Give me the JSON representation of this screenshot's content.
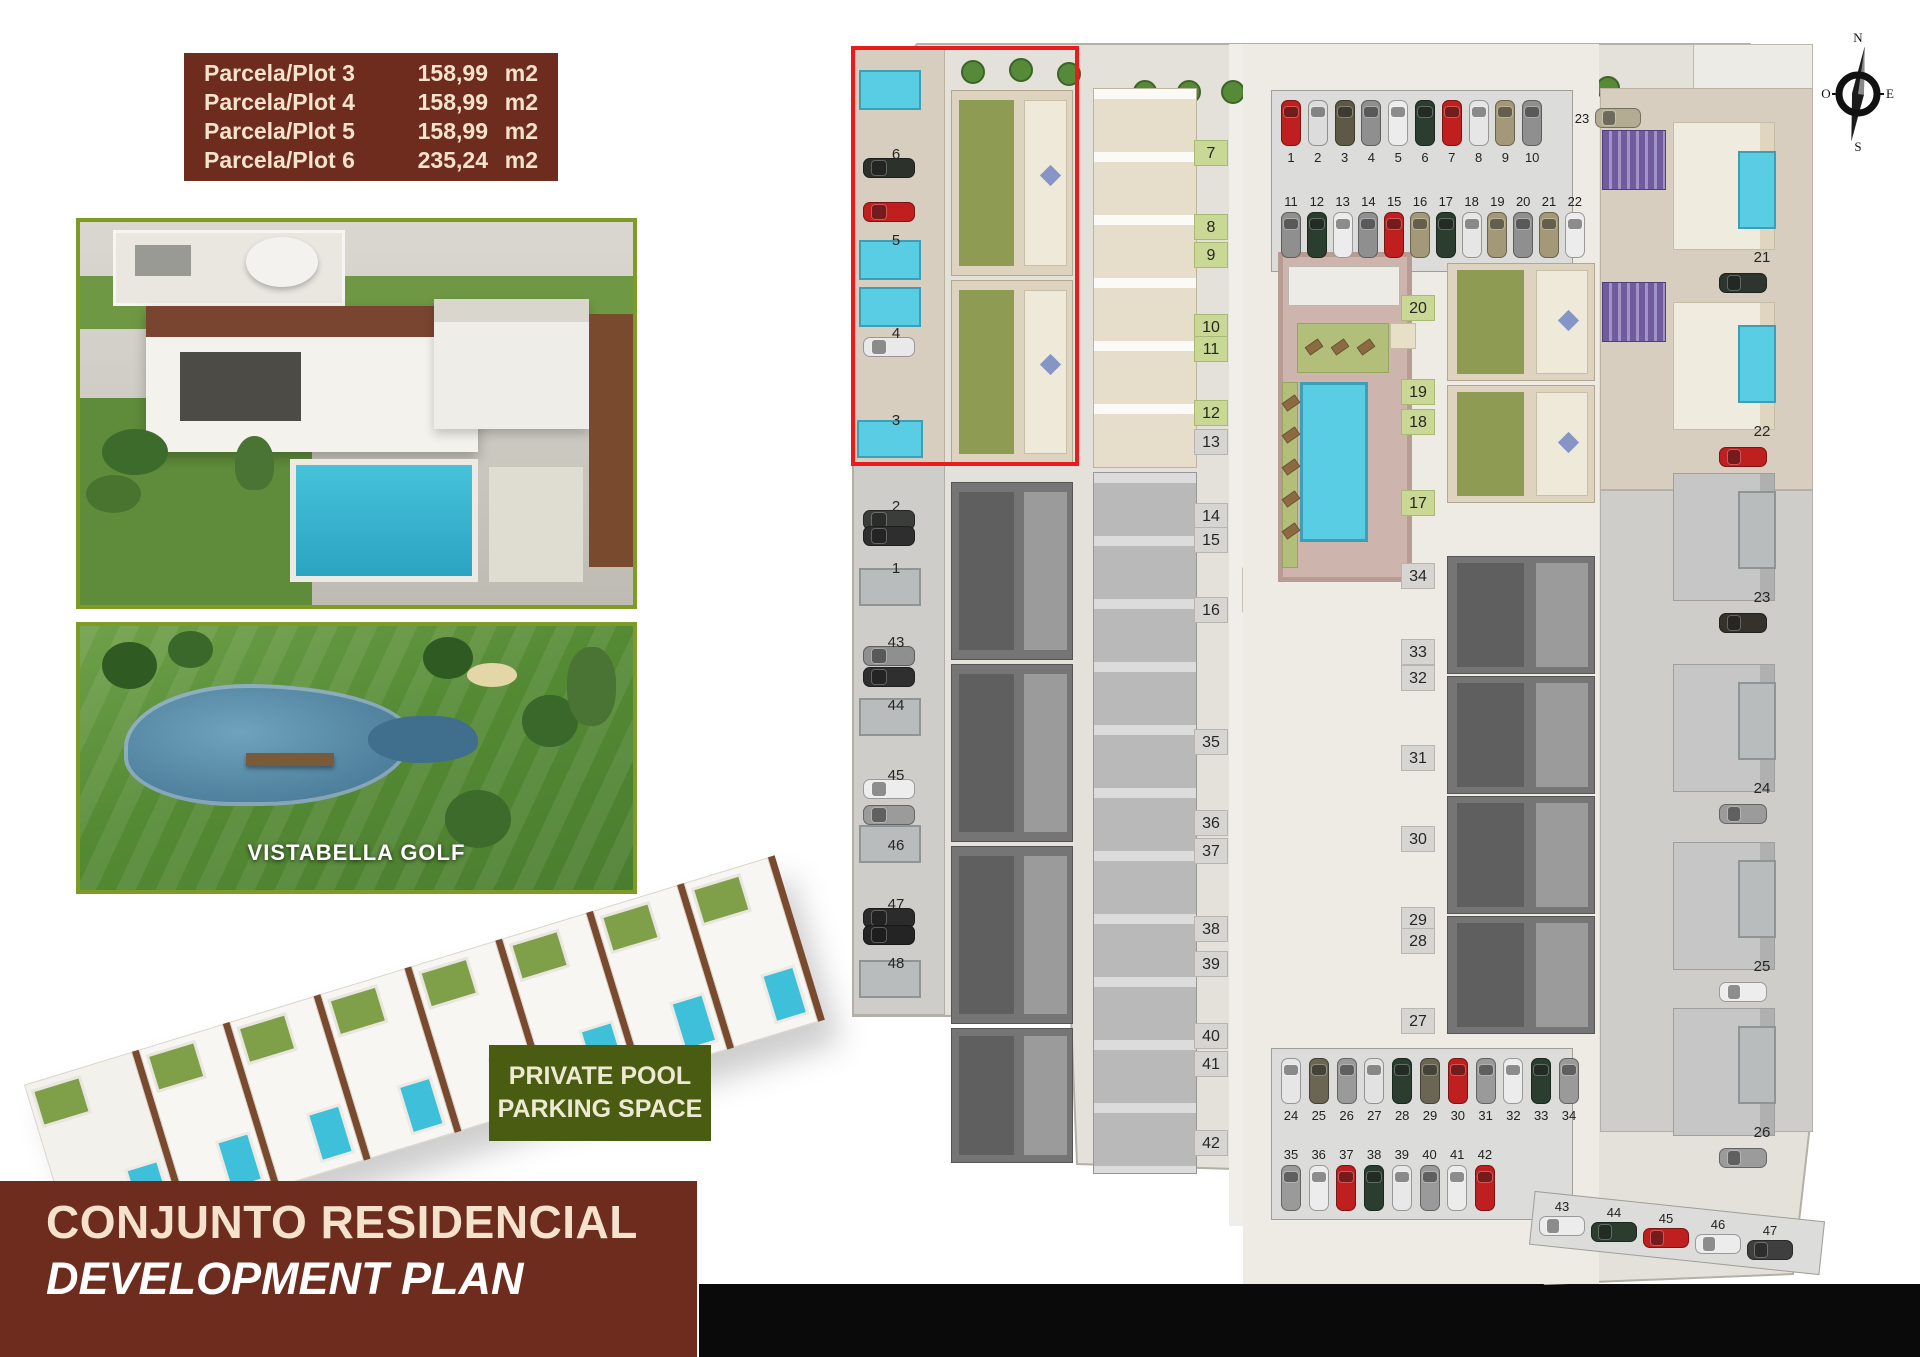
{
  "header_table": {
    "rows": [
      {
        "label": "Parcela/Plot 3",
        "value": "158,99",
        "unit": "m2"
      },
      {
        "label": "Parcela/Plot 4",
        "value": "158,99",
        "unit": "m2"
      },
      {
        "label": "Parcela/Plot 5",
        "value": "158,99",
        "unit": "m2"
      },
      {
        "label": "Parcela/Plot 6",
        "value": "235,24",
        "unit": "m2"
      }
    ]
  },
  "golf_photo": {
    "caption": "VISTABELLA GOLF"
  },
  "feature_badge": {
    "line1": "PRIVATE POOL",
    "line2": "PARKING SPACE"
  },
  "footer_title": {
    "line1": "CONJUNTO RESIDENCIAL",
    "line2": "DEVELOPMENT PLAN"
  },
  "compass": {
    "north": "N",
    "south": "S",
    "east": "E",
    "west": "O"
  },
  "colors": {
    "maroon": "#6d2c1e",
    "cream": "#f4e2cd",
    "badge_green": "#4a5c12",
    "photo_border_green": "#7e9b25",
    "highlight_red": "#e81c1c",
    "pool_blue": "#59cde4",
    "garden_olive": "#8e9b52",
    "pergola_purple": "#6f5b9e"
  },
  "site_plan": {
    "highlighted_plots": [
      "3",
      "4",
      "5",
      "6"
    ],
    "chip_columns": [
      {
        "id": "left-strip",
        "x": 34,
        "style": "plain",
        "car": {
          "x": 18,
          "w": 52,
          "h": 20,
          "dy": 16
        },
        "items": [
          {
            "num": "6",
            "y": 112,
            "car_color": "#2c312c"
          },
          {
            "num": "5",
            "y": 198,
            "car_color": "#bf1f1f",
            "car_dy": -26
          },
          {
            "num": "4",
            "y": 291,
            "car_color": "#e9e9e9"
          },
          {
            "num": "3",
            "y": 378
          },
          {
            "num": "2",
            "y": 464,
            "car_color": "#3a3d3a"
          },
          {
            "num": "1",
            "y": 526,
            "car_color": "#2e2e2e",
            "car_dy": -30
          },
          {
            "num": "43",
            "y": 600,
            "car_color": "#8f8f8f"
          },
          {
            "num": "44",
            "y": 663,
            "car_color": "#2f2f2f",
            "car_dy": -26
          },
          {
            "num": "45",
            "y": 733,
            "car_color": "#ededed"
          },
          {
            "num": "46",
            "y": 803,
            "car_color": "#9b9b9b",
            "car_dy": -28
          },
          {
            "num": "47",
            "y": 862,
            "car_color": "#2b2b2b"
          },
          {
            "num": "48",
            "y": 921,
            "car_color": "#242424",
            "car_dy": -26
          }
        ]
      },
      {
        "id": "center-upper",
        "x": 349,
        "style": "green",
        "items": [
          {
            "num": "7",
            "y": 110
          },
          {
            "num": "8",
            "y": 184
          },
          {
            "num": "9",
            "y": 212
          },
          {
            "num": "10",
            "y": 284
          },
          {
            "num": "11",
            "y": 306
          },
          {
            "num": "12",
            "y": 370
          }
        ]
      },
      {
        "id": "center-mid",
        "x": 349,
        "style": "gray",
        "items": [
          {
            "num": "13",
            "y": 399
          },
          {
            "num": "14",
            "y": 473
          },
          {
            "num": "15",
            "y": 497
          },
          {
            "num": "16",
            "y": 567
          }
        ]
      },
      {
        "id": "center-lower",
        "x": 349,
        "style": "gray",
        "items": [
          {
            "num": "35",
            "y": 699
          },
          {
            "num": "36",
            "y": 780
          },
          {
            "num": "37",
            "y": 808
          },
          {
            "num": "38",
            "y": 886
          },
          {
            "num": "39",
            "y": 921
          },
          {
            "num": "40",
            "y": 993
          },
          {
            "num": "41",
            "y": 1021
          },
          {
            "num": "42",
            "y": 1100
          }
        ]
      },
      {
        "id": "midright-green",
        "x": 556,
        "style": "green",
        "items": [
          {
            "num": "20",
            "y": 265
          },
          {
            "num": "19",
            "y": 349
          },
          {
            "num": "18",
            "y": 379
          },
          {
            "num": "17",
            "y": 460
          }
        ]
      },
      {
        "id": "midright-gray",
        "x": 556,
        "style": "gray",
        "items": [
          {
            "num": "34",
            "y": 533
          },
          {
            "num": "33",
            "y": 609
          },
          {
            "num": "32",
            "y": 635
          },
          {
            "num": "31",
            "y": 715
          },
          {
            "num": "30",
            "y": 796
          },
          {
            "num": "29",
            "y": 877
          },
          {
            "num": "28",
            "y": 898
          },
          {
            "num": "27",
            "y": 978
          }
        ]
      },
      {
        "id": "right-strip",
        "x": 900,
        "style": "plain",
        "car": {
          "x": 874,
          "w": 48,
          "h": 20,
          "dy": 28
        },
        "pool": {
          "x": 893,
          "w": 38,
          "h": 78,
          "dy": -94
        },
        "items": [
          {
            "num": "21",
            "y": 215,
            "car_color": "#2e352e",
            "pool": "blue"
          },
          {
            "num": "22",
            "y": 389,
            "car_color": "#bf1f1f",
            "pool": "blue"
          },
          {
            "num": "23",
            "y": 555,
            "car_color": "#35322c",
            "pool": "gray"
          },
          {
            "num": "24",
            "y": 746,
            "car_color": "#9b9b9b",
            "pool": "gray"
          },
          {
            "num": "25",
            "y": 924,
            "car_color": "#ededed",
            "pool": "gray"
          },
          {
            "num": "26",
            "y": 1090,
            "car_color": "#9b9b9b",
            "pool": "gray"
          }
        ]
      }
    ],
    "parking_rows": [
      {
        "id": "street-top-a",
        "x": 436,
        "y": 70,
        "step": 26.8,
        "orient": "v",
        "label": "below",
        "spots": [
          {
            "num": "1",
            "color": "#bf1f1f"
          },
          {
            "num": "2",
            "color": "#dcdcdc"
          },
          {
            "num": "3",
            "color": "#5e5946"
          },
          {
            "num": "4",
            "color": "#8f8f8f"
          },
          {
            "num": "5",
            "color": "#ececec"
          },
          {
            "num": "6",
            "color": "#2a3d2e"
          },
          {
            "num": "7",
            "color": "#bf1f1f"
          },
          {
            "num": "8",
            "color": "#e6e6e6"
          },
          {
            "num": "9",
            "color": "#a39877"
          },
          {
            "num": "10",
            "color": "#8f8f8f"
          }
        ]
      },
      {
        "id": "street-top-b",
        "x": 436,
        "y": 182,
        "step": 25.8,
        "orient": "v",
        "label": "above",
        "spots": [
          {
            "num": "11",
            "color": "#8f8f8f"
          },
          {
            "num": "12",
            "color": "#2a3d2e"
          },
          {
            "num": "13",
            "color": "#ececec"
          },
          {
            "num": "14",
            "color": "#8f8f8f"
          },
          {
            "num": "15",
            "color": "#bf1f1f"
          },
          {
            "num": "16",
            "color": "#a39877"
          },
          {
            "num": "17",
            "color": "#2a3d2e"
          },
          {
            "num": "18",
            "color": "#e6e6e6"
          },
          {
            "num": "19",
            "color": "#a39877"
          },
          {
            "num": "20",
            "color": "#8f8f8f"
          },
          {
            "num": "21",
            "color": "#a39877"
          },
          {
            "num": "22",
            "color": "#ececec"
          }
        ]
      },
      {
        "id": "spot-23",
        "x": 750,
        "y": 78,
        "step": 0,
        "orient": "h",
        "label": "left",
        "spots": [
          {
            "num": "23",
            "color": "#b3ac93"
          }
        ]
      },
      {
        "id": "street-bottom-a",
        "x": 436,
        "y": 1028,
        "step": 27.8,
        "orient": "v",
        "label": "below",
        "spots": [
          {
            "num": "24",
            "color": "#e6e6e6"
          },
          {
            "num": "25",
            "color": "#6b6553"
          },
          {
            "num": "26",
            "color": "#9a9a9a"
          },
          {
            "num": "27",
            "color": "#e2e2e2"
          },
          {
            "num": "28",
            "color": "#2a3d2e"
          },
          {
            "num": "29",
            "color": "#6b6553"
          },
          {
            "num": "30",
            "color": "#bf1f1f"
          },
          {
            "num": "31",
            "color": "#9a9a9a"
          },
          {
            "num": "32",
            "color": "#ececec"
          },
          {
            "num": "33",
            "color": "#2a3d2e"
          },
          {
            "num": "34",
            "color": "#9a9a9a"
          }
        ]
      },
      {
        "id": "street-bottom-b",
        "x": 436,
        "y": 1135,
        "step": 27.7,
        "orient": "v",
        "label": "above",
        "spots": [
          {
            "num": "35",
            "color": "#9a9a9a"
          },
          {
            "num": "36",
            "color": "#ececec"
          },
          {
            "num": "37",
            "color": "#bf1f1f"
          },
          {
            "num": "38",
            "color": "#2a3d2e"
          },
          {
            "num": "39",
            "color": "#e8e8e8"
          },
          {
            "num": "40",
            "color": "#9a9a9a"
          },
          {
            "num": "41",
            "color": "#ececec"
          },
          {
            "num": "42",
            "color": "#bf1f1f"
          }
        ]
      },
      {
        "id": "street-corner",
        "x": 694,
        "y": 1186,
        "step": 52,
        "dy": 6,
        "orient": "h",
        "label": "above",
        "spots": [
          {
            "num": "43",
            "color": "#ececec"
          },
          {
            "num": "44",
            "color": "#2a3d2e"
          },
          {
            "num": "45",
            "color": "#bf1f1f"
          },
          {
            "num": "46",
            "color": "#ececec"
          },
          {
            "num": "47",
            "color": "#3f3f3f"
          }
        ]
      }
    ]
  }
}
